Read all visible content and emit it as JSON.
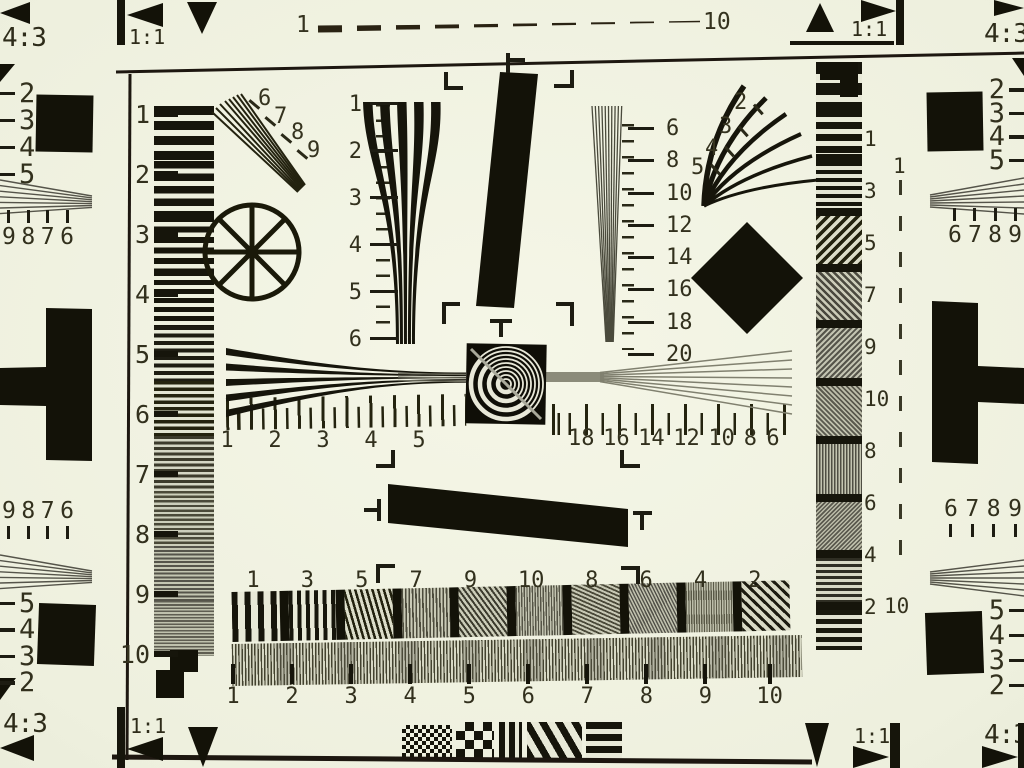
{
  "colors": {
    "background": "#eef0de",
    "ink": "#16150b",
    "gray_line": "#55544a",
    "mid_gray": "#8b8b7a"
  },
  "corner_labels": {
    "aspect_43": "4:3",
    "aspect_11": "1:1"
  },
  "top_dash_scale": {
    "start": "1",
    "end": "10"
  },
  "right_dash_scale": {
    "start": "1",
    "end": "10"
  },
  "scales": {
    "left_ruler": [
      "1",
      "2",
      "3",
      "4",
      "5",
      "6",
      "7",
      "8",
      "9",
      "10"
    ],
    "right_ruler": [
      "1",
      "3",
      "5",
      "7",
      "9",
      "10",
      "8",
      "6",
      "4",
      "2"
    ],
    "vertical_wedge": [
      "1",
      "2",
      "3",
      "4",
      "5",
      "6"
    ],
    "fine_wedge": [
      "6",
      "8",
      "10",
      "12",
      "14",
      "16",
      "18",
      "20"
    ],
    "fan_upper_left": [
      "6",
      "7",
      "8",
      "9"
    ],
    "fan_upper_right": [
      "2",
      "3",
      "4",
      "5"
    ],
    "h_ruler_left": [
      "1",
      "2",
      "3",
      "4",
      "5"
    ],
    "h_ruler_right": [
      "18",
      "16",
      "14",
      "12",
      "10",
      "8",
      "6"
    ],
    "band_top": [
      "1",
      "3",
      "5",
      "7",
      "9",
      "10",
      "8",
      "6",
      "4",
      "2"
    ],
    "band_bottom": [
      "1",
      "2",
      "3",
      "4",
      "5",
      "6",
      "7",
      "8",
      "9",
      "10"
    ],
    "edge_left_upper": [
      "2",
      "3",
      "4",
      "5"
    ],
    "edge_left_group_upper": [
      "9",
      "8",
      "7",
      "6"
    ],
    "edge_left_group_lower": [
      "9",
      "8",
      "7",
      "6"
    ],
    "edge_left_lower": [
      "5",
      "4",
      "3",
      "2"
    ],
    "edge_right_upper": [
      "2",
      "3",
      "4",
      "5"
    ],
    "edge_right_group_upper": [
      "6",
      "7",
      "8",
      "9"
    ],
    "edge_right_group_lower": [
      "6",
      "7",
      "8",
      "9"
    ],
    "edge_right_lower": [
      "5",
      "4",
      "3",
      "2"
    ]
  },
  "graphics": {
    "wheel_icon": "eight-spoke-wheel",
    "center_target_icon": "concentric-ring-target",
    "diamond_icon": "black-diamond",
    "checker_icon": "checkerboard-blocks",
    "wedge_icons": "hyperbolic-resolution-wedges"
  }
}
